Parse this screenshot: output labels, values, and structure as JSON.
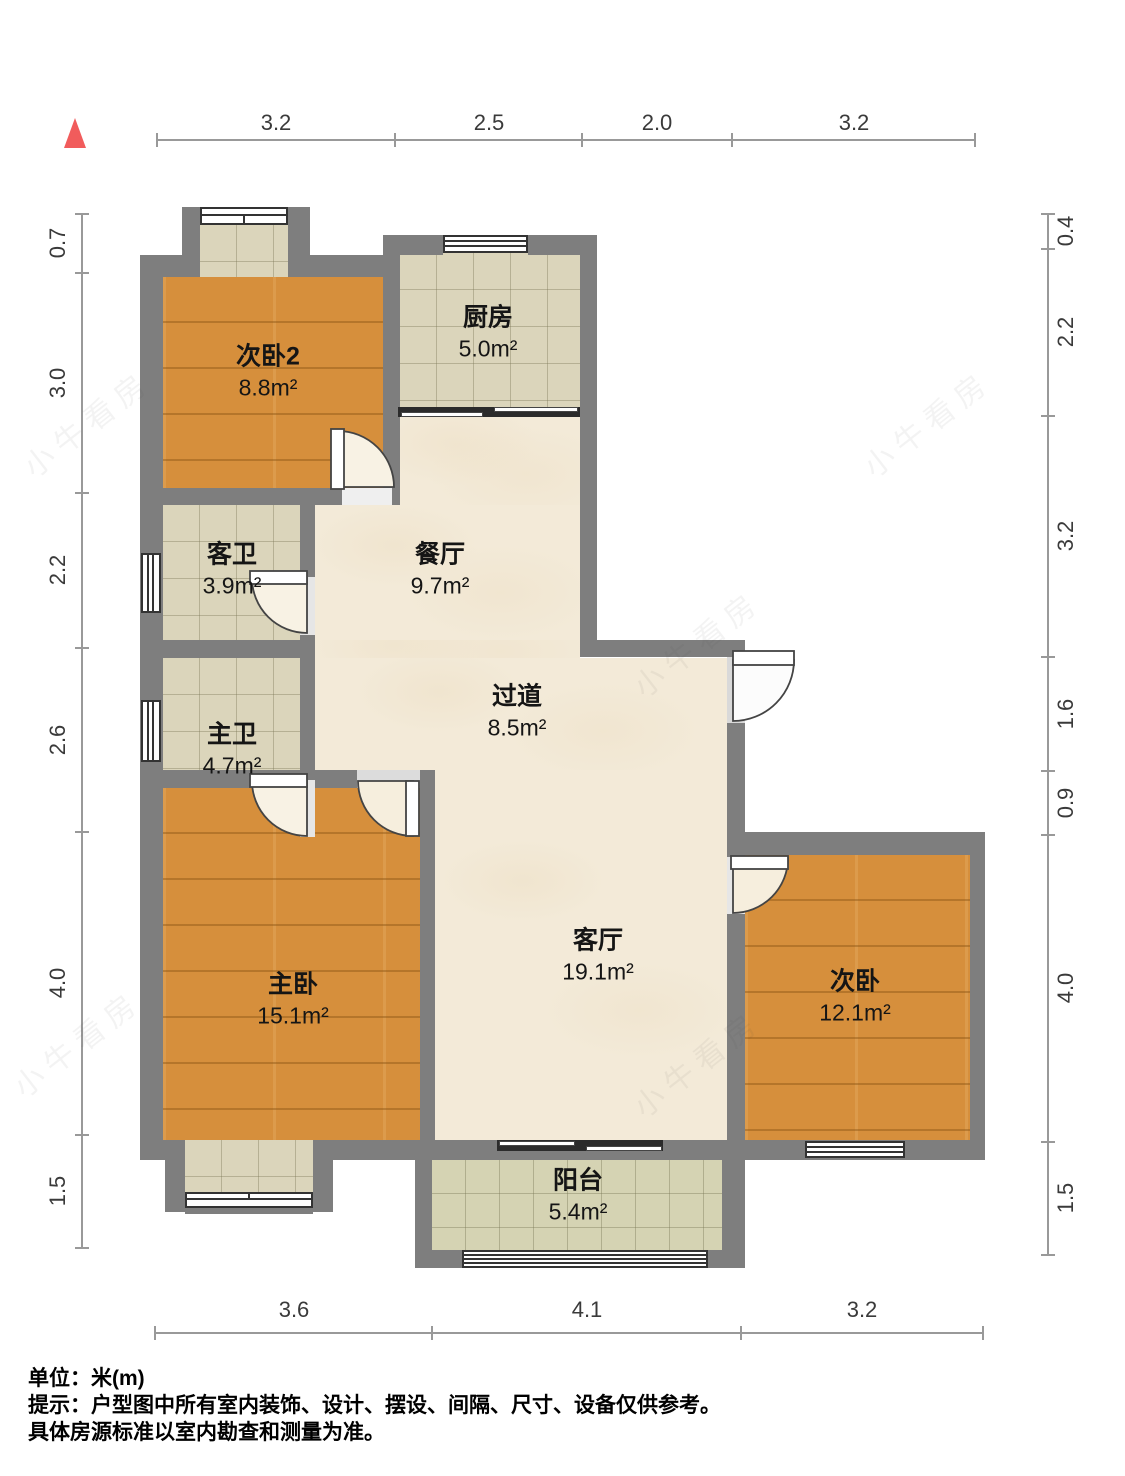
{
  "dimensions": {
    "top": [
      "3.2",
      "2.5",
      "2.0",
      "3.2"
    ],
    "bottom": [
      "3.6",
      "4.1",
      "3.2"
    ],
    "left": [
      "0.7",
      "3.0",
      "2.2",
      "2.6",
      "4.0",
      "1.5"
    ],
    "right": [
      "0.4",
      "2.2",
      "3.2",
      "1.6",
      "0.9",
      "4.0",
      "1.5"
    ]
  },
  "rooms": [
    {
      "name": "次卧2",
      "area": "8.8m²"
    },
    {
      "name": "厨房",
      "area": "5.0m²"
    },
    {
      "name": "客卫",
      "area": "3.9m²"
    },
    {
      "name": "餐厅",
      "area": "9.7m²"
    },
    {
      "name": "主卫",
      "area": "4.7m²"
    },
    {
      "name": "过道",
      "area": "8.5m²"
    },
    {
      "name": "主卧",
      "area": "15.1m²"
    },
    {
      "name": "客厅",
      "area": "19.1m²"
    },
    {
      "name": "次卧",
      "area": "12.1m²"
    },
    {
      "name": "阳台",
      "area": "5.4m²"
    }
  ],
  "footer": {
    "unit_line": "单位：米(m)",
    "note_line1": "提示：户型图中所有室内装饰、设计、摆设、间隔、尺寸、设备仅供参考。",
    "note_line2": "具体房源标准以室内勘查和测量为准。"
  },
  "watermark": "小牛看房",
  "colors": {
    "wall": "#7E7E7E",
    "wood_floor": "#D68F3C",
    "tile_floor": "#DBD5BB",
    "balcony_tile": "#D5D3B3",
    "hall_floor": "#F3EAD8",
    "north_arrow": "#F15C5C"
  }
}
